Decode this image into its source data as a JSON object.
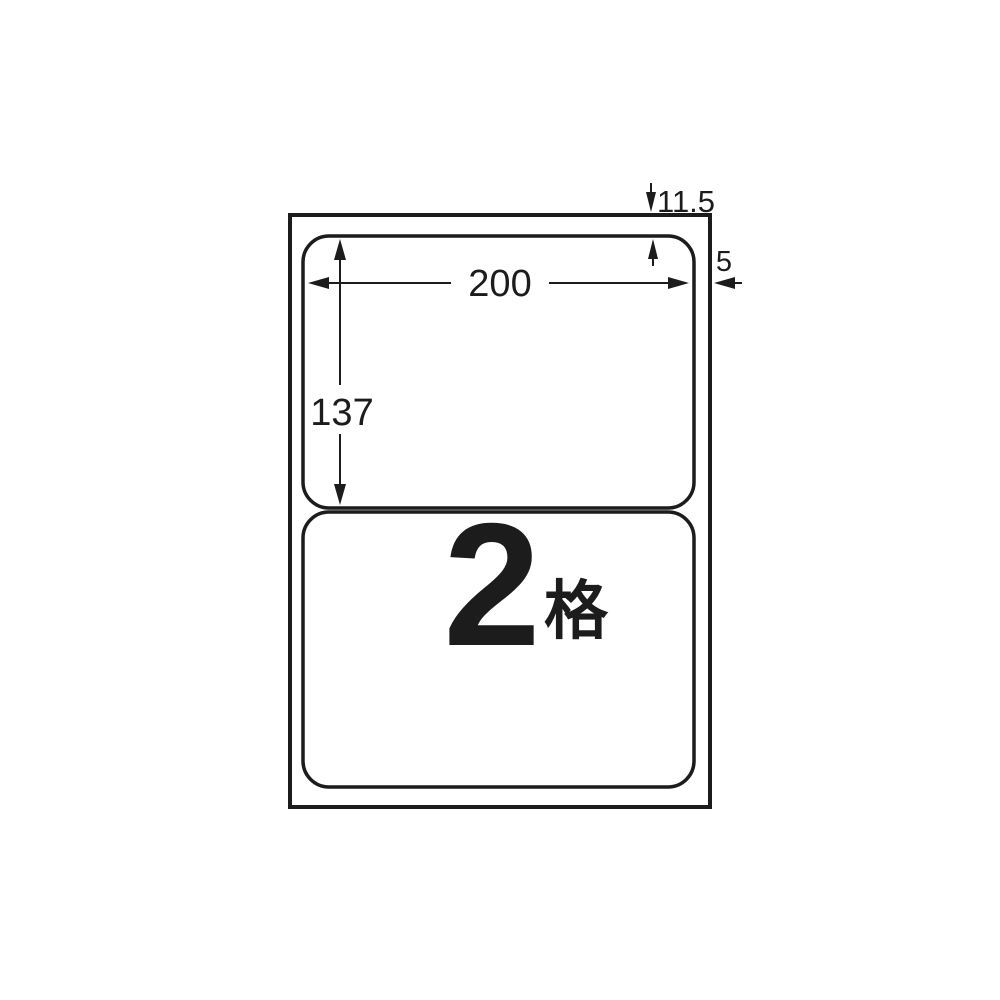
{
  "page": {
    "background": "#ffffff"
  },
  "colors": {
    "accent_magenta": "#E4007F",
    "line_black": "#1c1c1c"
  },
  "diagram": {
    "label_width": "200",
    "label_height": "137",
    "margin_top": "11.5",
    "margin_right": "5",
    "cell_count": {
      "number": "2",
      "suffix": "格"
    }
  }
}
